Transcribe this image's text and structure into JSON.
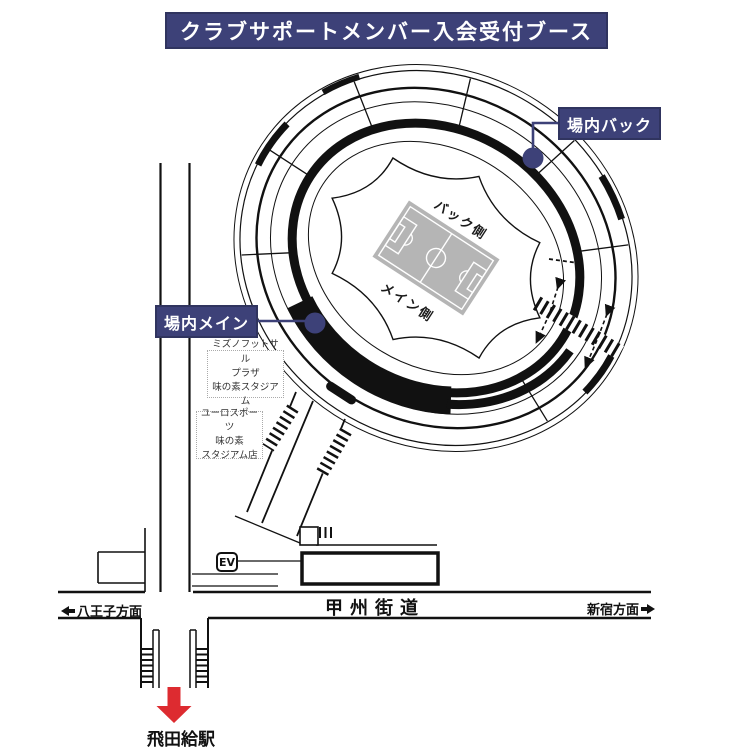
{
  "header": {
    "title": "クラブサポートメンバー入会受付ブース"
  },
  "stadium": {
    "booths": {
      "back": "場内バック",
      "main": "場内メイン"
    },
    "stands": {
      "back": "バック側",
      "main": "メイン側"
    }
  },
  "landmarks": {
    "mizuno": {
      "lines": [
        "ミズノフットサル",
        "プラザ",
        "味の素スタジアム"
      ]
    },
    "euro": {
      "lines": [
        "ユーロスポーツ",
        "味の素",
        "スタジアム店"
      ]
    },
    "elevator": {
      "label": "EV"
    }
  },
  "roads": {
    "koshu": {
      "name": "甲州街道"
    },
    "directions": {
      "west": "八王子方面",
      "east": "新宿方面"
    }
  },
  "station": {
    "name": "飛田給駅"
  },
  "colors": {
    "navy": "#3d4178",
    "red": "#dd2b30",
    "field_gray": "#b5b5b5",
    "line_black": "#111111"
  }
}
